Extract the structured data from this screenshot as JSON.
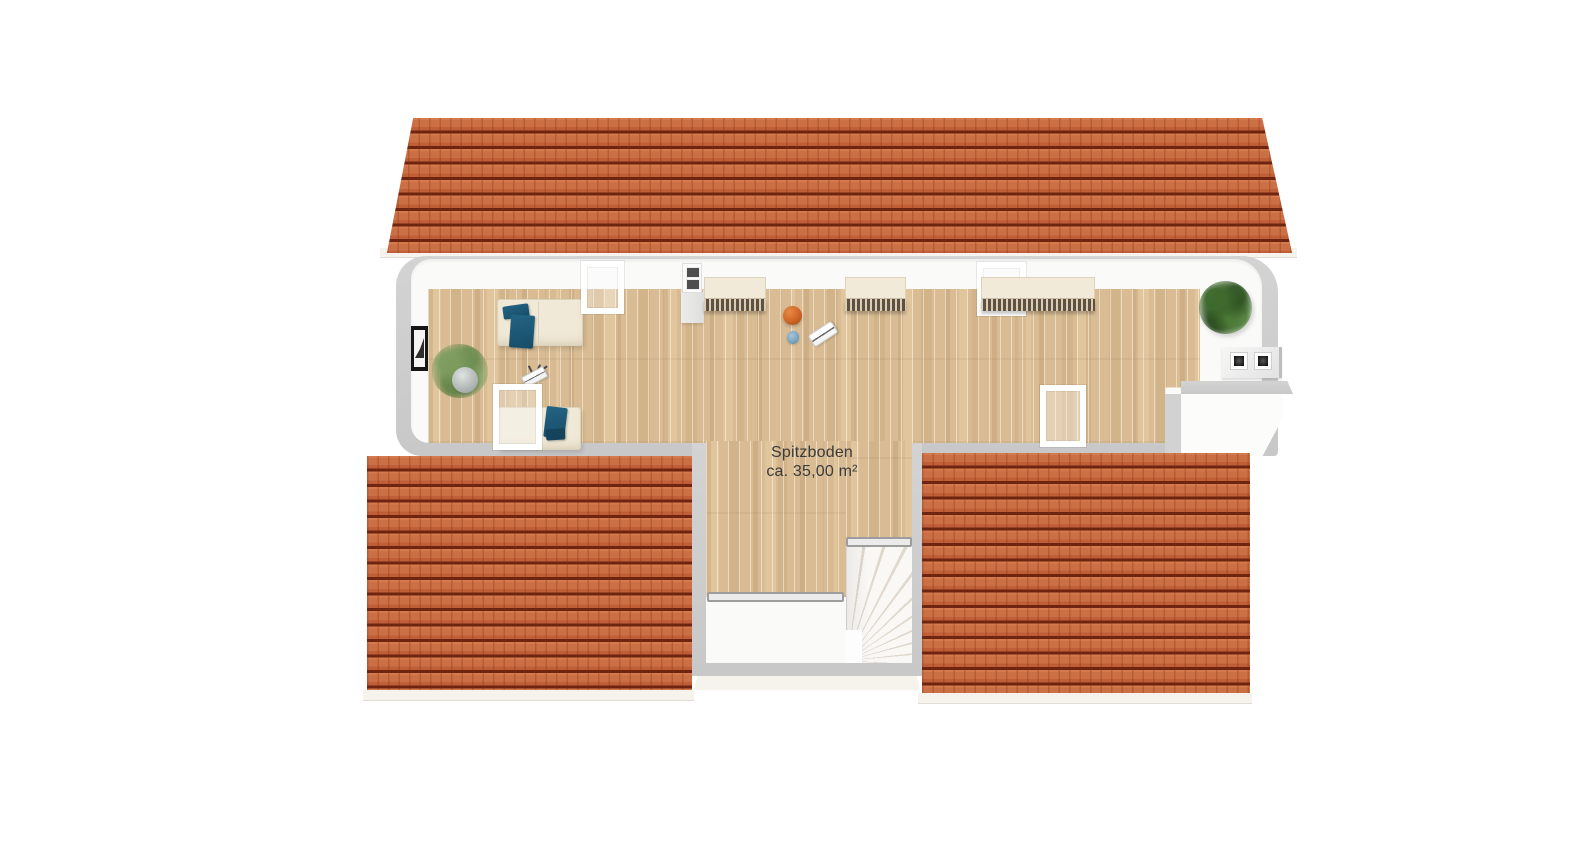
{
  "floorplan": {
    "room": {
      "name": "Spitzboden",
      "area_label": "ca. 35,00 m²"
    },
    "colors": {
      "background": "#ffffff",
      "roof_tile": "#c97047",
      "roof_tile_dark": "#6e2410",
      "wall_gray": "#cdcdcd",
      "wall_white": "#fafaf9",
      "floor_wood": "#d9bc93",
      "furniture_cream": "#f0e9d7",
      "textile_teal": "#1d5a78",
      "plant_light_green": "#7c9c5e",
      "plant_dark_green": "#3e6a2e",
      "ball_orange": "#cf6426",
      "label_text": "#3b3b3b"
    },
    "elements": [
      {
        "id": "roof-top",
        "type": "roof"
      },
      {
        "id": "roof-bottom-left",
        "type": "roof"
      },
      {
        "id": "roof-bottom-right",
        "type": "roof"
      },
      {
        "id": "attic-room",
        "type": "room"
      },
      {
        "id": "winder-staircase",
        "type": "stairs"
      },
      {
        "id": "stair-railing-left",
        "type": "railing"
      },
      {
        "id": "stair-railing-right",
        "type": "railing"
      },
      {
        "id": "sofa-upper",
        "type": "furniture"
      },
      {
        "id": "sofa-lower",
        "type": "furniture"
      },
      {
        "id": "sideboard-left",
        "type": "furniture"
      },
      {
        "id": "sideboard-middle",
        "type": "furniture"
      },
      {
        "id": "sideboard-right",
        "type": "furniture"
      },
      {
        "id": "skylight-window",
        "count": 4
      },
      {
        "id": "potted-plant-left",
        "type": "plant"
      },
      {
        "id": "potted-plant-right",
        "type": "plant"
      },
      {
        "id": "picture-frame",
        "type": "decor"
      },
      {
        "id": "chimney-small",
        "type": "chimney"
      },
      {
        "id": "chimney-double-flue",
        "type": "chimney"
      },
      {
        "id": "basketball",
        "type": "decor"
      },
      {
        "id": "laptop-stand",
        "type": "decor"
      },
      {
        "id": "skateboard",
        "type": "decor"
      },
      {
        "id": "blue-ball",
        "type": "decor"
      }
    ]
  }
}
